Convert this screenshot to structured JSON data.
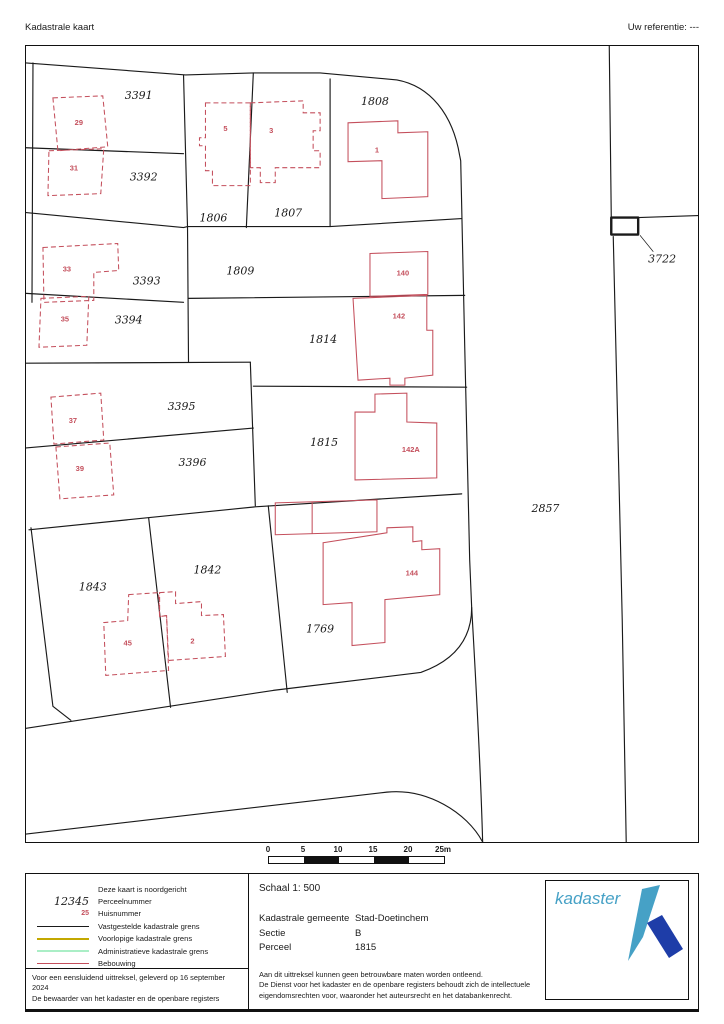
{
  "header": {
    "title": "Kadastrale kaart",
    "reference_label": "Uw referentie: ---"
  },
  "colors": {
    "building": "#c44f5c",
    "boundary": "#1a1a1a"
  },
  "map": {
    "parcels": [
      {
        "label": "3391",
        "x": 113,
        "y": 53
      },
      {
        "label": "3392",
        "x": 118,
        "y": 135
      },
      {
        "label": "1806",
        "x": 188,
        "y": 176
      },
      {
        "label": "1807",
        "x": 263,
        "y": 171
      },
      {
        "label": "1808",
        "x": 350,
        "y": 59
      },
      {
        "label": "1809",
        "x": 215,
        "y": 229
      },
      {
        "label": "3393",
        "x": 121,
        "y": 239
      },
      {
        "label": "3394",
        "x": 103,
        "y": 278
      },
      {
        "label": "1814",
        "x": 298,
        "y": 298
      },
      {
        "label": "3395",
        "x": 156,
        "y": 365
      },
      {
        "label": "3396",
        "x": 167,
        "y": 421
      },
      {
        "label": "1815",
        "x": 299,
        "y": 401
      },
      {
        "label": "2857",
        "x": 521,
        "y": 467
      },
      {
        "label": "3722",
        "x": 638,
        "y": 217
      },
      {
        "label": "1843",
        "x": 67,
        "y": 546
      },
      {
        "label": "1842",
        "x": 182,
        "y": 529
      },
      {
        "label": "1769",
        "x": 295,
        "y": 588
      }
    ],
    "houses": [
      {
        "label": "29",
        "x": 53,
        "y": 79
      },
      {
        "label": "31",
        "x": 48,
        "y": 125
      },
      {
        "label": "5",
        "x": 200,
        "y": 85
      },
      {
        "label": "3",
        "x": 246,
        "y": 87
      },
      {
        "label": "1",
        "x": 352,
        "y": 107
      },
      {
        "label": "33",
        "x": 41,
        "y": 226
      },
      {
        "label": "35",
        "x": 39,
        "y": 276
      },
      {
        "label": "140",
        "x": 378,
        "y": 230
      },
      {
        "label": "142",
        "x": 374,
        "y": 273
      },
      {
        "label": "37",
        "x": 47,
        "y": 378
      },
      {
        "label": "39",
        "x": 54,
        "y": 426
      },
      {
        "label": "142A",
        "x": 386,
        "y": 407
      },
      {
        "label": "144",
        "x": 387,
        "y": 531
      },
      {
        "label": "45",
        "x": 102,
        "y": 601
      },
      {
        "label": "2",
        "x": 167,
        "y": 599
      }
    ]
  },
  "scalebar": {
    "ticks": [
      "0",
      "5",
      "10",
      "15",
      "20",
      "25m"
    ],
    "segment_colors": [
      "#ffffff",
      "#111111",
      "#ffffff",
      "#111111",
      "#ffffff"
    ]
  },
  "legend": {
    "rows": [
      {
        "type": "none",
        "sample": "",
        "color": "",
        "label": "Deze kaart is noordgericht"
      },
      {
        "type": "parcel",
        "sample": "12345",
        "color": "",
        "label": "Perceelnummer"
      },
      {
        "type": "house",
        "sample": "25",
        "color": "",
        "label": "Huisnummer"
      },
      {
        "type": "line",
        "sample": "",
        "color": "#1a1a1a",
        "label": "Vastgestelde kadastrale grens"
      },
      {
        "type": "line",
        "sample": "",
        "color": "#c3a800",
        "label": "Voorlopige kadastrale grens"
      },
      {
        "type": "line",
        "sample": "",
        "color": "#aaeec6",
        "label": "Administratieve kadastrale grens"
      },
      {
        "type": "line",
        "sample": "",
        "color": "#c44f5c",
        "label": "Bebouwing"
      }
    ]
  },
  "info": {
    "scale_label": "Schaal 1: 500",
    "rows": [
      {
        "label": "Kadastrale gemeente",
        "value": "Stad-Doetinchem"
      },
      {
        "label": "Sectie",
        "value": "B"
      },
      {
        "label": "Perceel",
        "value": "1815"
      }
    ],
    "disclaimer": [
      "Aan dit uittreksel kunnen geen betrouwbare maten worden ontleend.",
      "De Dienst voor het kadaster en de openbare registers behoudt zich de intellectuele",
      "eigendomsrechten voor, waaronder het auteursrecht en het databankenrecht."
    ],
    "certify": [
      "Voor een eensluidend uittreksel, geleverd op 16 september 2024",
      "De bewaarder van het kadaster en de openbare registers"
    ]
  },
  "logo": {
    "text": "kadaster",
    "light": "#46a1c6",
    "dark": "#1e3da8"
  }
}
